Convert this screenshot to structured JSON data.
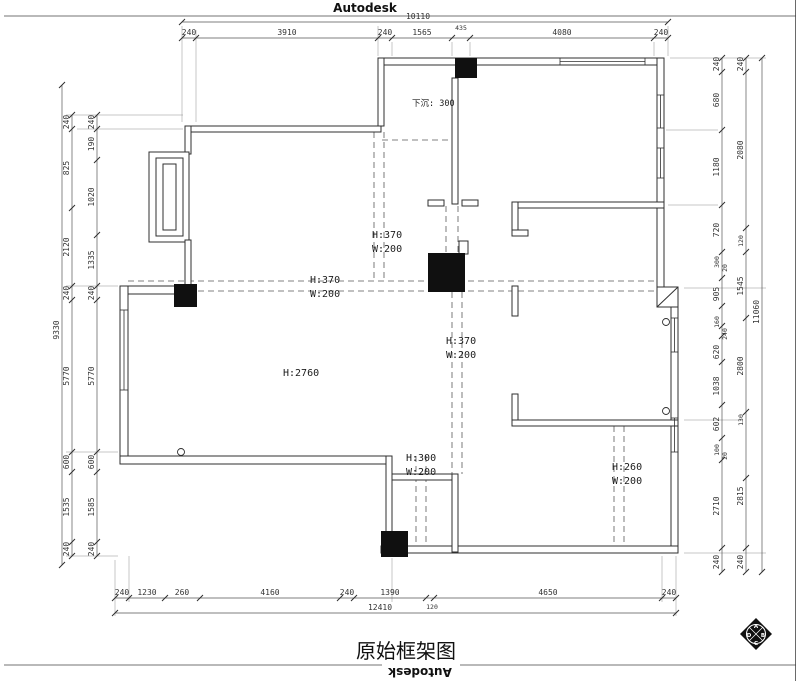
{
  "colors": {
    "background": "#ffffff",
    "line": "#2f2f2f",
    "column_fill": "#101010",
    "dashed": "#5a5a5a"
  },
  "brand": {
    "top": "Autodesk",
    "bottom": "Autodesk"
  },
  "title": "原始框架图",
  "logo": {
    "top": "A",
    "left": "D",
    "right": "B",
    "bottom": "C"
  },
  "ann": {
    "sunken": "下沉: 300",
    "beam1h": "H:370",
    "beam1w": "W:200",
    "beam2h": "H:370",
    "beam2w": "W:200",
    "beam3h": "H:370",
    "beam3w": "W:200",
    "beam4h": "H:300",
    "beam4w": "W:200",
    "beam5h": "H:260",
    "beam5w": "W:200",
    "ceiling": "H:2760"
  },
  "dims": {
    "top": {
      "total": "10110",
      "extra": "435",
      "s": [
        "240",
        "3910",
        "240",
        "1565",
        "4080",
        "240"
      ]
    },
    "bottom": {
      "total": "12410",
      "extra": "120",
      "s": [
        "240",
        "1230",
        "260",
        "4160",
        "240",
        "1390",
        "4650",
        "240"
      ]
    },
    "left": {
      "total": "9330",
      "outer": [
        "240",
        "825",
        "2120",
        "240",
        "5770",
        "600",
        "1535",
        "240"
      ],
      "inner": [
        "240",
        "190",
        "1020",
        "1335",
        "240",
        "5770",
        "600",
        "1585",
        "240"
      ]
    },
    "right": {
      "total": "11060",
      "a": [
        "240",
        "680",
        "1180",
        "720",
        "300",
        "20",
        "905",
        "160",
        "240",
        "620",
        "1038",
        "602",
        "100",
        "20",
        "2710",
        "240"
      ],
      "b": [
        "240",
        "2080",
        "120",
        "1545",
        "2800",
        "130",
        "2815",
        "240"
      ]
    }
  }
}
